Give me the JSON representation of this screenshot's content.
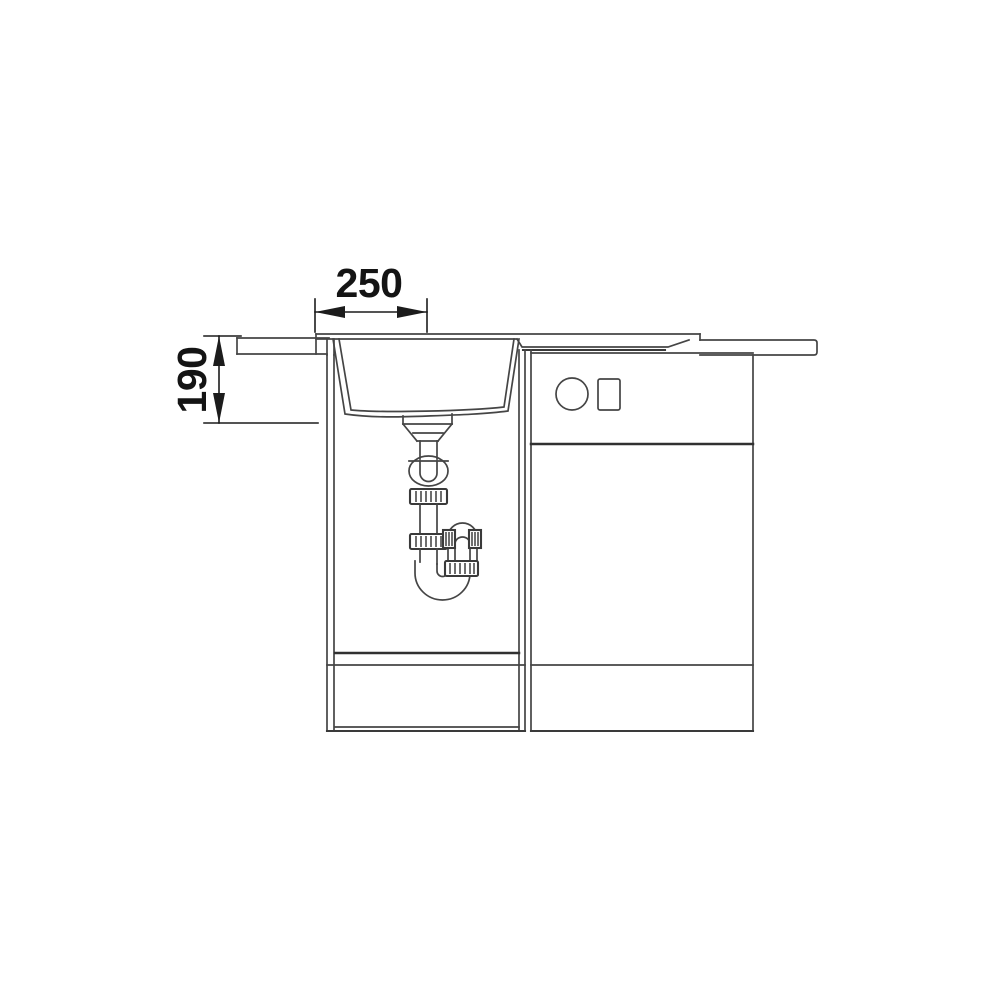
{
  "diagram": {
    "dim_horizontal": {
      "value": "250",
      "orientation": "horizontal"
    },
    "dim_vertical": {
      "value": "190",
      "orientation": "vertical"
    },
    "colors": {
      "background": "#ffffff",
      "line": "#454545",
      "line_dark": "#313131",
      "dimension_text": "#141414"
    }
  }
}
